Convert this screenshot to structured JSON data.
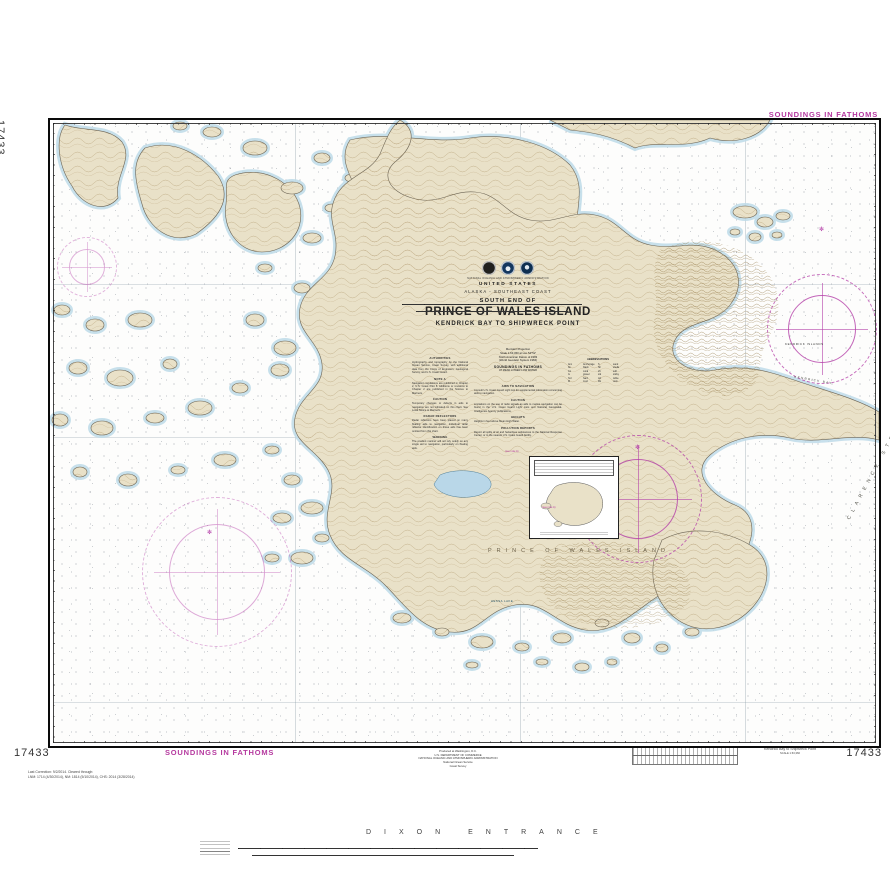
{
  "page": {
    "chart_number": "17433",
    "soundings_top": "SOUNDINGS IN FATHOMS",
    "soundings_bottom": "SOUNDINGS IN FATHOMS",
    "corrections_line1": "Last Correction: 9/2/2014.  Cleared through:",
    "corrections_line2": "LNM: 1714 (4/30/2014), NM: 1814 (5/10/2014), CHS: 2014 (3/28/2014)",
    "imprint_1": "Produced at Washington, D.C.",
    "imprint_2": "U.S. DEPARTMENT OF COMMERCE",
    "imprint_3": "NATIONAL OCEANIC AND ATMOSPHERIC ADMINISTRATION",
    "imprint_4": "National Ocean Service",
    "imprint_5": "Coast Survey",
    "corner_label_title": "Kendrick Bay to Shipwreck Point",
    "corner_label_sub": "SCALE 1:63,360"
  },
  "title_block": {
    "agency_line": "NATIONAL OCEANIC AND ATMOSPHERIC ADMINISTRATION",
    "country": "UNITED STATES",
    "region": "ALASKA - SOUTHEAST COAST",
    "super_title": "SOUTH END OF",
    "title": "PRINCE OF WALES ISLAND",
    "subtitle": "KENDRICK BAY TO SHIPWRECK POINT"
  },
  "projection_block": {
    "line1": "Mercator Projection",
    "line2": "Scale 1:63,360 at Lat. 54°52'",
    "line3": "North American Datum of 1983",
    "line4": "(World Geodetic System 1984)",
    "soundings": "SOUNDINGS IN FATHOMS",
    "soundings_sub": "AT MEAN LOWER LOW WATER"
  },
  "notes_left": [
    {
      "heading": "AUTHORITIES",
      "body": "Hydrography and topography by the National Ocean Service, Coast Survey, with additional data from the Corps of Engineers, Geological Survey, and U.S. Coast Guard."
    },
    {
      "heading": "NOTE A",
      "body": "Navigation regulations are published in Chapter 2, U.S. Coast Pilot 8. Additions or revisions to Chapter 2 are published in the Notices to Mariners."
    },
    {
      "heading": "CAUTION",
      "body": "Temporary changes or defects in aids to navigation are not indicated on this chart. See Local Notice to Mariners."
    },
    {
      "heading": "RADAR REFLECTORS",
      "body": "Radar reflectors have been placed on many floating aids to navigation. Individual radar reflector identification on these aids has been omitted from this chart."
    },
    {
      "heading": "WARNING",
      "body": "The prudent mariner will not rely solely on any single aid to navigation, particularly on floating aids."
    }
  ],
  "notes_center": [
    {
      "heading": "AIDS TO NAVIGATION",
      "body": "Consult U.S. Coast Guard Light List for supplemental information concerning aids to navigation."
    },
    {
      "heading": "CAUTION",
      "body": "Limitations on the use of radio signals as aids to marine navigation can be found in the U.S. Coast Guard Light Lists and National Geospatial-Intelligence Agency publications."
    },
    {
      "heading": "HEIGHTS",
      "body": "Heights in feet above Mean High Water."
    },
    {
      "heading": "POLLUTION REPORTS",
      "body": "Report all spills of oil and hazardous substances to the National Response Center, or to the nearest U.S. Coast Guard facility."
    }
  ],
  "abbreviations": {
    "title": "ABBREVIATIONS",
    "rows": [
      [
        "Anc",
        "Anchorage",
        "S",
        "sand"
      ],
      [
        "bk",
        "black",
        "Sh",
        "shells"
      ],
      [
        "Co",
        "coral",
        "sft",
        "soft"
      ],
      [
        "G",
        "gravel",
        "stk",
        "sticky"
      ],
      [
        "hrd",
        "hard",
        "wh",
        "white"
      ],
      [
        "M",
        "mud",
        "Rk",
        "rock"
      ]
    ]
  },
  "geo_labels": {
    "island": "PRINCE OF WALES ISLAND",
    "entrance": "DIXON ENTRANCE",
    "strait": "CLARENCE STRAIT",
    "kendrick_islands": "KENDRICK ISLANDS",
    "kendrick_bay": "KENDRICK BAY",
    "lake": "HESSA LAKE",
    "water_note_1": "(see note A)",
    "water_note_2": "(see note A)"
  },
  "symbols": {
    "north_mark": "✻"
  },
  "colors": {
    "magenta_accent": "#b5399f",
    "land_tan": "#e9e1c8",
    "contour_brown": "#a5895a",
    "shoal_blue": "#bedbe9",
    "lake_blue": "#b9d7e8"
  }
}
